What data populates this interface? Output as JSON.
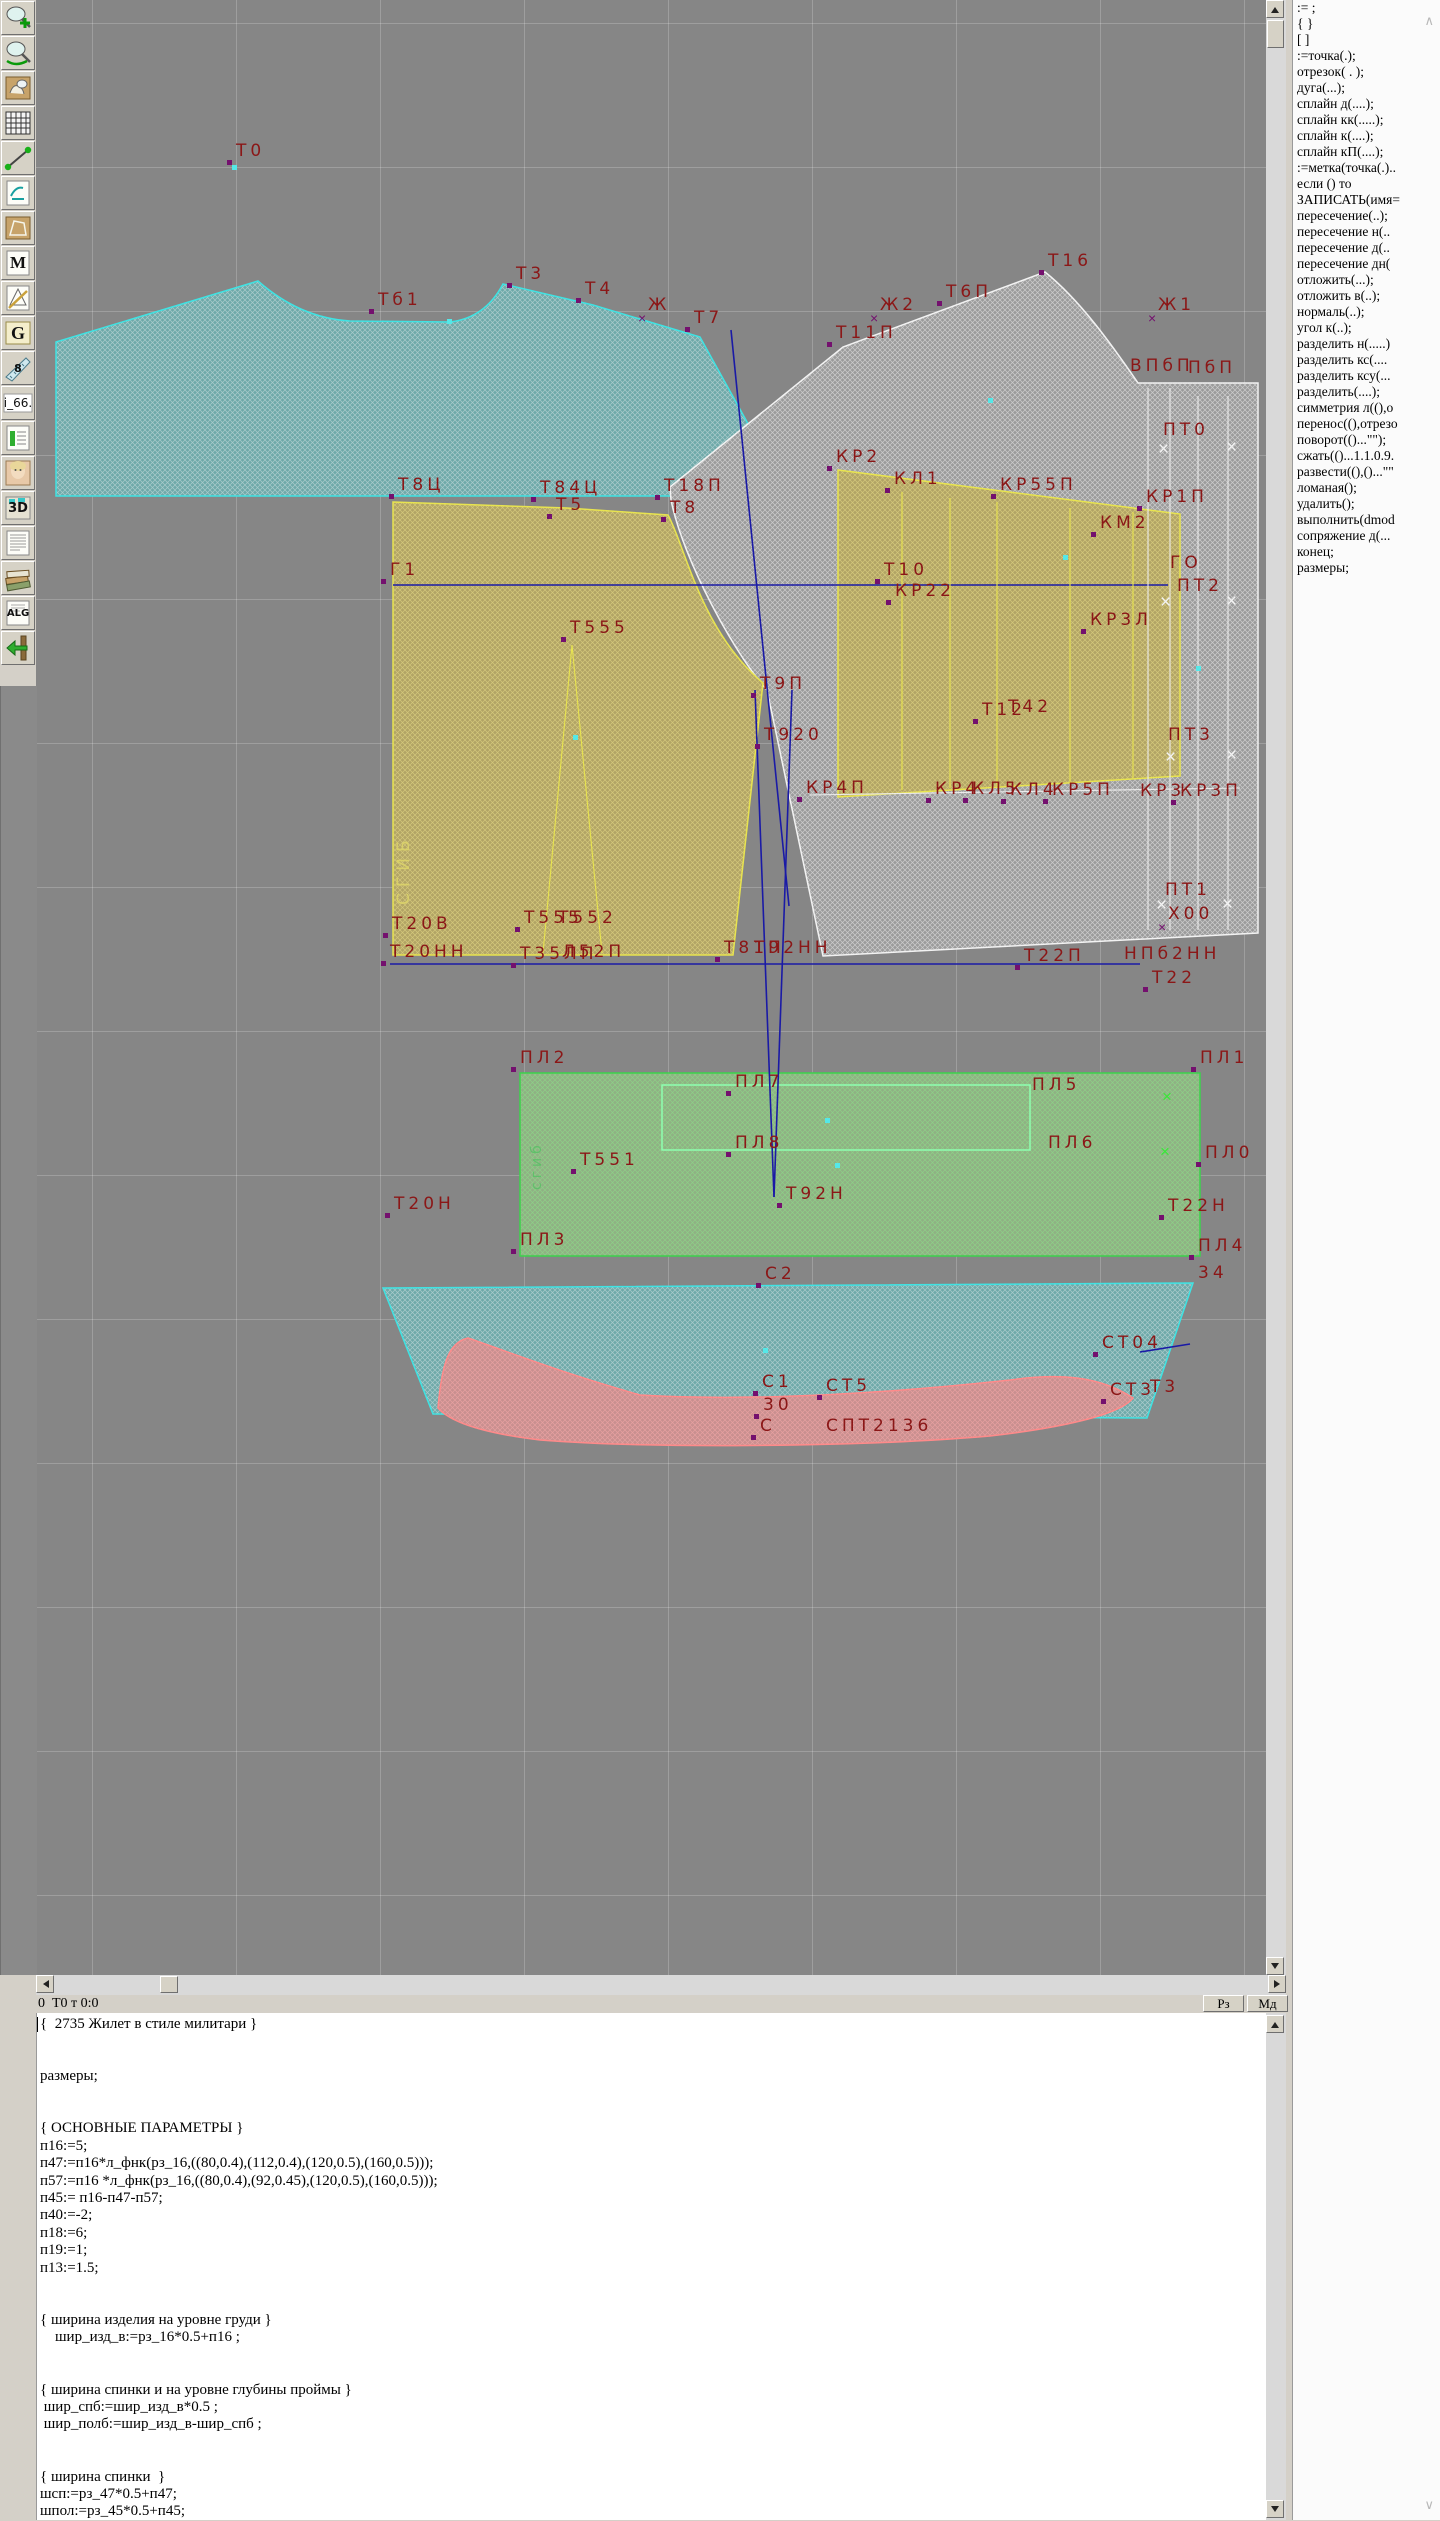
{
  "app_type": "garment-pattern-cad",
  "toolbar": {
    "items": [
      {
        "name": "zoom-in-icon"
      },
      {
        "name": "zoom-icon"
      },
      {
        "name": "patterns-icon"
      },
      {
        "name": "grid-icon"
      },
      {
        "name": "segment-icon"
      },
      {
        "name": "sketch-icon"
      },
      {
        "name": "pattern-sheet-icon"
      },
      {
        "name": "m-icon",
        "glyph": "M"
      },
      {
        "name": "drafting-icon"
      },
      {
        "name": "g-icon",
        "glyph": "G"
      },
      {
        "name": "ruler-icon",
        "glyph": "8"
      },
      {
        "name": "i66-field",
        "glyph": "i_66."
      },
      {
        "name": "table-icon"
      },
      {
        "name": "portrait-icon"
      },
      {
        "name": "threed-icon",
        "glyph": "3D"
      },
      {
        "name": "textdoc-icon"
      },
      {
        "name": "library-icon"
      },
      {
        "name": "alg-icon",
        "glyph": "ALG"
      },
      {
        "name": "exit-icon"
      }
    ]
  },
  "canvas": {
    "bg": "#868686",
    "label_color": "#8b1717",
    "labels": [
      {
        "t": "Т0",
        "x": 236,
        "y": 143
      },
      {
        "t": "Т3",
        "x": 516,
        "y": 266
      },
      {
        "t": "Тб1",
        "x": 378,
        "y": 292
      },
      {
        "t": "Т4",
        "x": 585,
        "y": 281
      },
      {
        "t": "Ж",
        "x": 648,
        "y": 297,
        "mk": "xp"
      },
      {
        "t": "Т7",
        "x": 694,
        "y": 310
      },
      {
        "t": "Т16",
        "x": 1048,
        "y": 253
      },
      {
        "t": "Т6П",
        "x": 946,
        "y": 284
      },
      {
        "t": "Ж2",
        "x": 880,
        "y": 297,
        "mk": "xp"
      },
      {
        "t": "Т11П",
        "x": 836,
        "y": 325
      },
      {
        "t": "Ж1",
        "x": 1158,
        "y": 297,
        "mk": "xp"
      },
      {
        "t": "ВПбП",
        "x": 1130,
        "y": 358,
        "m": 0
      },
      {
        "t": "ПбП",
        "x": 1188,
        "y": 360,
        "m": 0
      },
      {
        "t": "ПТ0",
        "x": 1163,
        "y": 422,
        "m": 0
      },
      {
        "t": "Т8Ц",
        "x": 398,
        "y": 477
      },
      {
        "t": "Т84Ц",
        "x": 540,
        "y": 480
      },
      {
        "t": "Т5",
        "x": 556,
        "y": 497
      },
      {
        "t": "Т18П",
        "x": 664,
        "y": 478
      },
      {
        "t": "Т8",
        "x": 670,
        "y": 500
      },
      {
        "t": "КР2",
        "x": 836,
        "y": 449
      },
      {
        "t": "КЛ1",
        "x": 894,
        "y": 471
      },
      {
        "t": "КР55П",
        "x": 1000,
        "y": 477
      },
      {
        "t": "КР1П",
        "x": 1146,
        "y": 489
      },
      {
        "t": "КМ2",
        "x": 1100,
        "y": 515
      },
      {
        "t": "Г1",
        "x": 390,
        "y": 562
      },
      {
        "t": "Т10",
        "x": 884,
        "y": 562
      },
      {
        "t": "КР22",
        "x": 895,
        "y": 583
      },
      {
        "t": "ГО",
        "x": 1170,
        "y": 555,
        "m": 0
      },
      {
        "t": "ПТ2",
        "x": 1177,
        "y": 578,
        "m": 0
      },
      {
        "t": "КР3Л",
        "x": 1090,
        "y": 612
      },
      {
        "t": "Т555",
        "x": 570,
        "y": 620
      },
      {
        "t": "Т9П",
        "x": 760,
        "y": 676
      },
      {
        "t": "Т920",
        "x": 764,
        "y": 727
      },
      {
        "t": "Т12",
        "x": 982,
        "y": 702
      },
      {
        "t": "Т42",
        "x": 1008,
        "y": 699,
        "m": 0
      },
      {
        "t": "ПТ3",
        "x": 1168,
        "y": 727,
        "m": 0
      },
      {
        "t": "СГИБ",
        "x": 396,
        "y": 905,
        "cls": "vy",
        "m": 0
      },
      {
        "t": "КР4П",
        "x": 806,
        "y": 780
      },
      {
        "t": "КР4",
        "x": 935,
        "y": 781
      },
      {
        "t": "КЛ5",
        "x": 972,
        "y": 781
      },
      {
        "t": "КЛ4",
        "x": 1010,
        "y": 782
      },
      {
        "t": "КР5П",
        "x": 1052,
        "y": 782
      },
      {
        "t": "КР3",
        "x": 1140,
        "y": 783,
        "m": 0
      },
      {
        "t": "КР3П",
        "x": 1180,
        "y": 783
      },
      {
        "t": "ПТ1",
        "x": 1165,
        "y": 882,
        "m": 0
      },
      {
        "t": "Х00",
        "x": 1168,
        "y": 906,
        "mk": "xp"
      },
      {
        "t": "Т20В",
        "x": 392,
        "y": 916
      },
      {
        "t": "Т555",
        "x": 524,
        "y": 910
      },
      {
        "t": "Т552",
        "x": 558,
        "y": 910,
        "m": 0
      },
      {
        "t": "Т20НН",
        "x": 390,
        "y": 944
      },
      {
        "t": "Т35ЛП",
        "x": 520,
        "y": 946
      },
      {
        "t": "Л52П",
        "x": 562,
        "y": 944,
        "m": 0
      },
      {
        "t": "Т81П",
        "x": 724,
        "y": 940
      },
      {
        "t": "Т92НН",
        "x": 754,
        "y": 940,
        "m": 0
      },
      {
        "t": "НПб2НН",
        "x": 1124,
        "y": 946,
        "m": 0
      },
      {
        "t": "Т22П",
        "x": 1024,
        "y": 948
      },
      {
        "t": "Т22",
        "x": 1152,
        "y": 970
      },
      {
        "t": "ПЛ2",
        "x": 520,
        "y": 1050
      },
      {
        "t": "ПЛ1",
        "x": 1200,
        "y": 1050
      },
      {
        "t": "ПЛ7",
        "x": 735,
        "y": 1074
      },
      {
        "t": "ПЛ5",
        "x": 1032,
        "y": 1077,
        "m": 0
      },
      {
        "t": "сгиб",
        "x": 530,
        "y": 1190,
        "cls": "vg",
        "m": 0
      },
      {
        "t": "ПЛ8",
        "x": 735,
        "y": 1135
      },
      {
        "t": "ПЛ6",
        "x": 1048,
        "y": 1135,
        "m": 0
      },
      {
        "t": "ПЛ0",
        "x": 1205,
        "y": 1145
      },
      {
        "t": "Т551",
        "x": 580,
        "y": 1152
      },
      {
        "t": "Т92Н",
        "x": 786,
        "y": 1186
      },
      {
        "t": "Т20Н",
        "x": 394,
        "y": 1196
      },
      {
        "t": "Т22Н",
        "x": 1168,
        "y": 1198
      },
      {
        "t": "ПЛ3",
        "x": 520,
        "y": 1232
      },
      {
        "t": "ПЛ4",
        "x": 1198,
        "y": 1238
      },
      {
        "t": "34",
        "x": 1198,
        "y": 1265,
        "m": 0
      },
      {
        "t": "С2",
        "x": 765,
        "y": 1266
      },
      {
        "t": "СТ04",
        "x": 1102,
        "y": 1335
      },
      {
        "t": "С1",
        "x": 762,
        "y": 1374
      },
      {
        "t": "СТ5",
        "x": 826,
        "y": 1378
      },
      {
        "t": "30",
        "x": 763,
        "y": 1397
      },
      {
        "t": "СТ3",
        "x": 1110,
        "y": 1382
      },
      {
        "t": "Т3",
        "x": 1150,
        "y": 1379,
        "m": 0
      },
      {
        "t": "С",
        "x": 760,
        "y": 1418
      },
      {
        "t": "СПТ2136",
        "x": 826,
        "y": 1418,
        "m": 0
      }
    ],
    "xmarks_white": [
      [
        1158,
        440
      ],
      [
        1226,
        438
      ],
      [
        1160,
        593
      ],
      [
        1226,
        592
      ],
      [
        1165,
        748
      ],
      [
        1226,
        746
      ],
      [
        1156,
        896
      ],
      [
        1222,
        895
      ]
    ],
    "xmarks_green": [
      [
        1162,
        1088
      ],
      [
        1160,
        1143
      ]
    ],
    "dots": [
      [
        232,
        165
      ],
      [
        447,
        319
      ],
      [
        988,
        398
      ],
      [
        573,
        735
      ],
      [
        1196,
        666
      ],
      [
        1063,
        555
      ],
      [
        825,
        1118
      ],
      [
        835,
        1163
      ],
      [
        763,
        1348
      ]
    ],
    "pieces": [
      {
        "name": "back-bodice-piece",
        "cls": "teal",
        "d": "M56,342 L258,281 Q300,318 350,321 L450,322 Q485,318 503,284 L593,305 L700,337 L788,496 L56,496 Z"
      },
      {
        "name": "front-bodice-piece",
        "cls": "white",
        "d": "M1045,272 C1080,300 1112,345 1138,383 L1258,383 L1258,933 L823,956 L767,690 C735,655 683,560 671,500 L670,487 L843,347 Z"
      },
      {
        "name": "back-lower-piece",
        "cls": "yellow",
        "d": "M393,502 L567,508 L668,515 C685,545 700,630 763,683 L733,955 L393,955 Z"
      },
      {
        "name": "front-yoke-piece",
        "cls": "yellow",
        "d": "M838,470 L1180,514 L1180,776 L838,797 Z"
      },
      {
        "name": "belt-piece",
        "cls": "green",
        "d": "M520,1073 L1200,1073 L1200,1256 L520,1256 Z"
      },
      {
        "name": "pocket-outline",
        "cls": "greenline",
        "d": "M662,1085 L1030,1085 L1030,1150 L662,1150 Z"
      },
      {
        "name": "bottom-band-piece",
        "cls": "teal",
        "d": "M383,1288 L1193,1283 L1147,1418 L433,1414 Z"
      },
      {
        "name": "trim-piece",
        "cls": "pink",
        "d": "M438,1408 C442,1360 450,1342 468,1338 C520,1356 560,1372 640,1395 C760,1402 900,1392 1010,1380 C1060,1373 1100,1376 1133,1398 C1120,1415 1060,1428 990,1436 C850,1448 640,1448 540,1440 C490,1434 452,1424 438,1408 Z"
      }
    ],
    "lines": [
      {
        "cls": "blue",
        "x1": 393,
        "y1": 585,
        "x2": 1168,
        "y2": 585
      },
      {
        "cls": "blue",
        "x1": 731,
        "y1": 330,
        "x2": 789,
        "y2": 906
      },
      {
        "cls": "blue",
        "x1": 755,
        "y1": 690,
        "x2": 774,
        "y2": 1197
      },
      {
        "cls": "blue",
        "x1": 792,
        "y1": 690,
        "x2": 774,
        "y2": 1197
      },
      {
        "cls": "blue",
        "x1": 390,
        "y1": 964,
        "x2": 1140,
        "y2": 964
      },
      {
        "cls": "blue",
        "x1": 1140,
        "y1": 1352,
        "x2": 1190,
        "y2": 1344
      },
      {
        "cls": "wline",
        "x1": 1148,
        "y1": 388,
        "x2": 1148,
        "y2": 930
      },
      {
        "cls": "wline",
        "x1": 1170,
        "y1": 388,
        "x2": 1170,
        "y2": 930
      },
      {
        "cls": "wline",
        "x1": 1198,
        "y1": 396,
        "x2": 1198,
        "y2": 930
      },
      {
        "cls": "wline",
        "x1": 1228,
        "y1": 396,
        "x2": 1228,
        "y2": 930
      },
      {
        "cls": "wline",
        "x1": 810,
        "y1": 795,
        "x2": 1240,
        "y2": 788
      },
      {
        "cls": "yline",
        "x1": 902,
        "y1": 492,
        "x2": 902,
        "y2": 790
      },
      {
        "cls": "yline",
        "x1": 950,
        "y1": 498,
        "x2": 950,
        "y2": 788
      },
      {
        "cls": "yline",
        "x1": 997,
        "y1": 502,
        "x2": 997,
        "y2": 786
      },
      {
        "cls": "yline",
        "x1": 1070,
        "y1": 508,
        "x2": 1070,
        "y2": 782
      },
      {
        "cls": "yline",
        "x1": 1133,
        "y1": 512,
        "x2": 1133,
        "y2": 778
      },
      {
        "cls": "yline",
        "x1": 572,
        "y1": 645,
        "x2": 543,
        "y2": 953
      },
      {
        "cls": "yline",
        "x1": 572,
        "y1": 645,
        "x2": 602,
        "y2": 953
      }
    ]
  },
  "statusbar": {
    "left_text": "0  Т0 т 0:0",
    "buttons": [
      "Рз",
      "Мд"
    ]
  },
  "sidebar": {
    "items": [
      ":= ;",
      "{  }",
      "[  ]",
      ":=точка(.);",
      "отрезок( . );",
      "дуга(...);",
      "сплайн  д(....);",
      "сплайн  кк(.....);",
      "сплайн  к(....);",
      "сплайн  кП(....);",
      ":=метка(точка(.)..",
      "если () то",
      "ЗАПИСАТЬ(имя=",
      "пересечение(..);",
      "пересечение  н(..",
      "пересечение  д(..",
      "пересечение  дн(",
      "отложить(...);",
      "отложить  в(..);",
      "нормаль(..);",
      "угол  к(..);",
      "разделить  н(.....)",
      "разделить  кс(....",
      "разделить  ксу(...",
      "разделить(....);",
      "симметрия  л((),о",
      "перенос((),отрезо",
      "поворот(()...\"\");",
      "сжать(()...1.1.0.9.",
      "развести((),()...\"\"",
      "ломаная();",
      "удалить();",
      "выполнить(dmod",
      "сопряжение  д(...",
      "конец;",
      "размеры;"
    ]
  },
  "panel": {
    "lines": [
      "{  2735 Жилет в стиле милитари }",
      "",
      "",
      "размеры;",
      "",
      "",
      "{ ОСНОВНЫЕ ПАРАМЕТРЫ }",
      "п16:=5;",
      "п47:=п16*л_фнк(рз_16,((80,0.4),(112,0.4),(120,0.5),(160,0.5)));",
      "п57:=п16 *л_фнк(рз_16,((80,0.4),(92,0.45),(120,0.5),(160,0.5)));",
      "п45:= п16-п47-п57;",
      "п40:=-2;",
      "п18:=6;",
      "п19:=1;",
      "п13:=1.5;",
      "",
      "",
      "{ ширина изделия на уровне груди }",
      "    шир_изд_в:=рз_16*0.5+п16 ;",
      "",
      "",
      "{ ширина спинки и на уровне глубины проймы }",
      " шир_спб:=шир_изд_в*0.5 ;",
      " шир_полб:=шир_изд_в-шир_спб ;",
      "",
      "",
      "{ ширина спинки  }",
      "шсп:=рз_47*0.5+п47;",
      "шпол:=рз_45*0.5+п45;"
    ]
  }
}
